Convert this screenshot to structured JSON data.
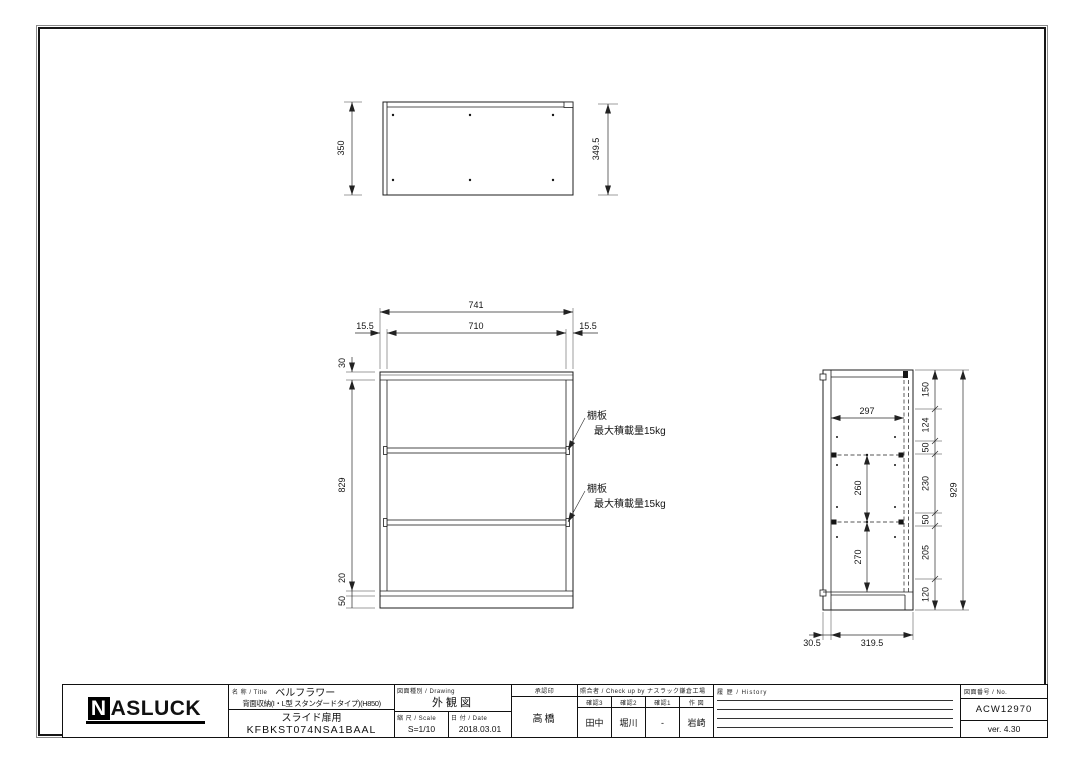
{
  "logo": {
    "n": "N",
    "rest": "ASLUCK"
  },
  "title_block": {
    "name_label": "名 称 / Title",
    "product_name": "ベルフラワー",
    "product_sub": "背面収納(I・L型 スタンダードタイプ)(H850)",
    "product_use": "スライド扉用",
    "product_code": "KFBKST074NSA1BAAL",
    "drawing_type_label": "図面種別 / Drawing",
    "drawing_type": "外観図",
    "scale_label": "縮 尺 / Scale",
    "scale": "S=1/10",
    "date_label": "日 付 / Date",
    "date": "2018.03.01",
    "approval_label": "承認印",
    "approver": "高橋",
    "check_label": "照合者 / Check up by ナスラック鎌倉工場",
    "check_cols": [
      {
        "label": "確認3",
        "value": "田中"
      },
      {
        "label": "確認2",
        "value": "堀川"
      },
      {
        "label": "確認1",
        "value": "-"
      },
      {
        "label": "作 図",
        "value": "岩崎"
      }
    ],
    "history_label": "履 歴 / History",
    "no_label": "図面番号 / No.",
    "drawing_no": "ACW12970",
    "version": "ver. 4.30"
  },
  "views": {
    "top": {
      "dim_height_left": "350",
      "dim_height_right": "349.5"
    },
    "front": {
      "dim_total_width": "741",
      "dim_inner_width": "710",
      "dim_side_left": "15.5",
      "dim_side_right": "15.5",
      "dim_top_panel": "30",
      "dim_body_height": "829",
      "dim_bottom_panel": "20",
      "dim_base_height": "50",
      "shelf_note_title": "棚板",
      "shelf_note_load": "最大積載量15kg"
    },
    "side": {
      "dim_inner_depth": "297",
      "dim_shelf_gap_upper": "260",
      "dim_shelf_gap_lower": "270",
      "right_chain": [
        "150",
        "124",
        "50",
        "230",
        "50",
        "205",
        "120"
      ],
      "dim_total_height": "929",
      "dim_door_depth": "30.5",
      "dim_body_depth": "319.5"
    }
  }
}
